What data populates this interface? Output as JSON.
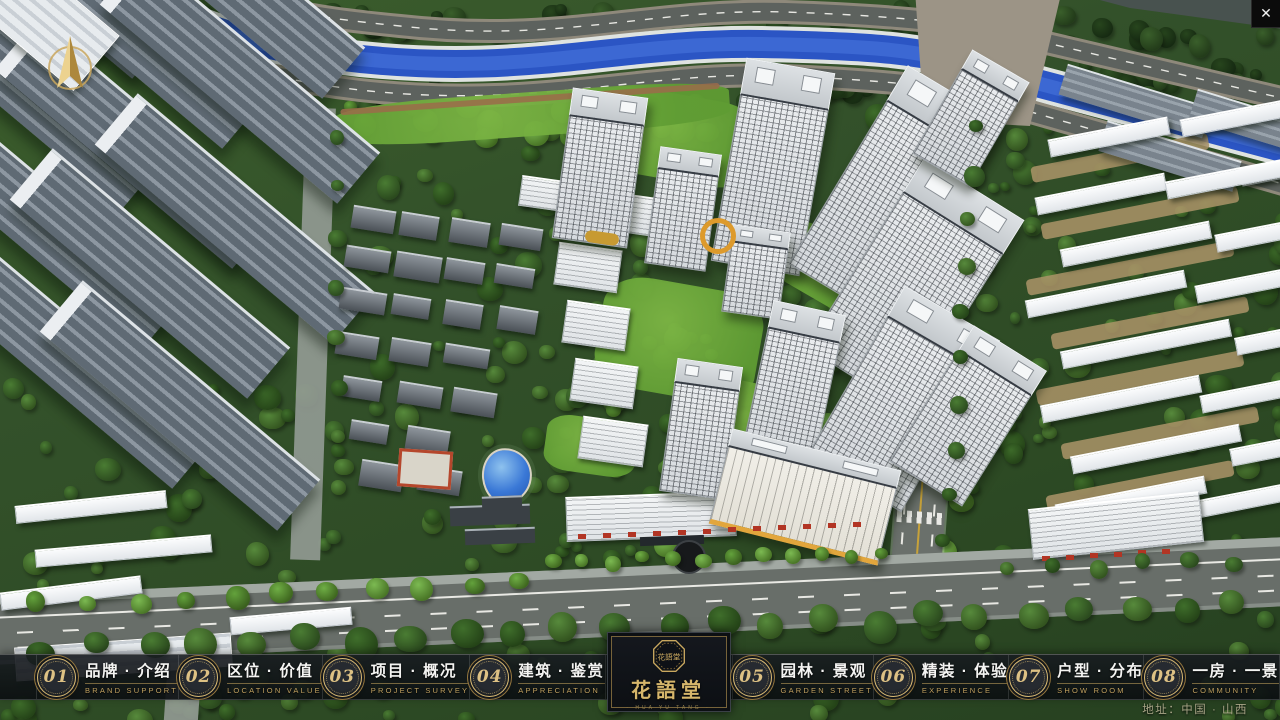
{
  "app": {
    "close_glyph": "✕"
  },
  "nav": {
    "items": [
      {
        "number": "01",
        "label_zh": "品牌 · 介绍",
        "label_en": "BRAND SUPPORT"
      },
      {
        "number": "02",
        "label_zh": "区位 · 价值",
        "label_en": "LOCATION VALUE"
      },
      {
        "number": "03",
        "label_zh": "项目 · 概况",
        "label_en": "PROJECT SURVEY"
      },
      {
        "number": "04",
        "label_zh": "建筑 · 鉴赏",
        "label_en": "APPRECIATION"
      },
      {
        "number": "05",
        "label_zh": "园林 · 景观",
        "label_en": "GARDEN STREET"
      },
      {
        "number": "06",
        "label_zh": "精装 · 体验",
        "label_en": "EXPERIENCE"
      },
      {
        "number": "07",
        "label_zh": "户型 · 分布",
        "label_en": "SHOW ROOM"
      },
      {
        "number": "08",
        "label_zh": "一房 · 一景",
        "label_en": "COMMUNITY"
      }
    ]
  },
  "logo": {
    "name_zh": "花語堂",
    "seal_text": "花語堂",
    "caption": "· HUA YU TANG ·"
  },
  "footer": {
    "address": "地址：中国 · 山西"
  },
  "icons": {
    "compass": "north-compass-icon",
    "close": "close-icon",
    "seal": "brand-seal-icon"
  },
  "colors": {
    "gold": "#c9a85f",
    "gold_dark": "#8a6f3a",
    "nav_bg": "#14181c",
    "river_blue": "#2b55c4",
    "road_gray": "#686e69",
    "tree_green": "#3a5f2b"
  }
}
